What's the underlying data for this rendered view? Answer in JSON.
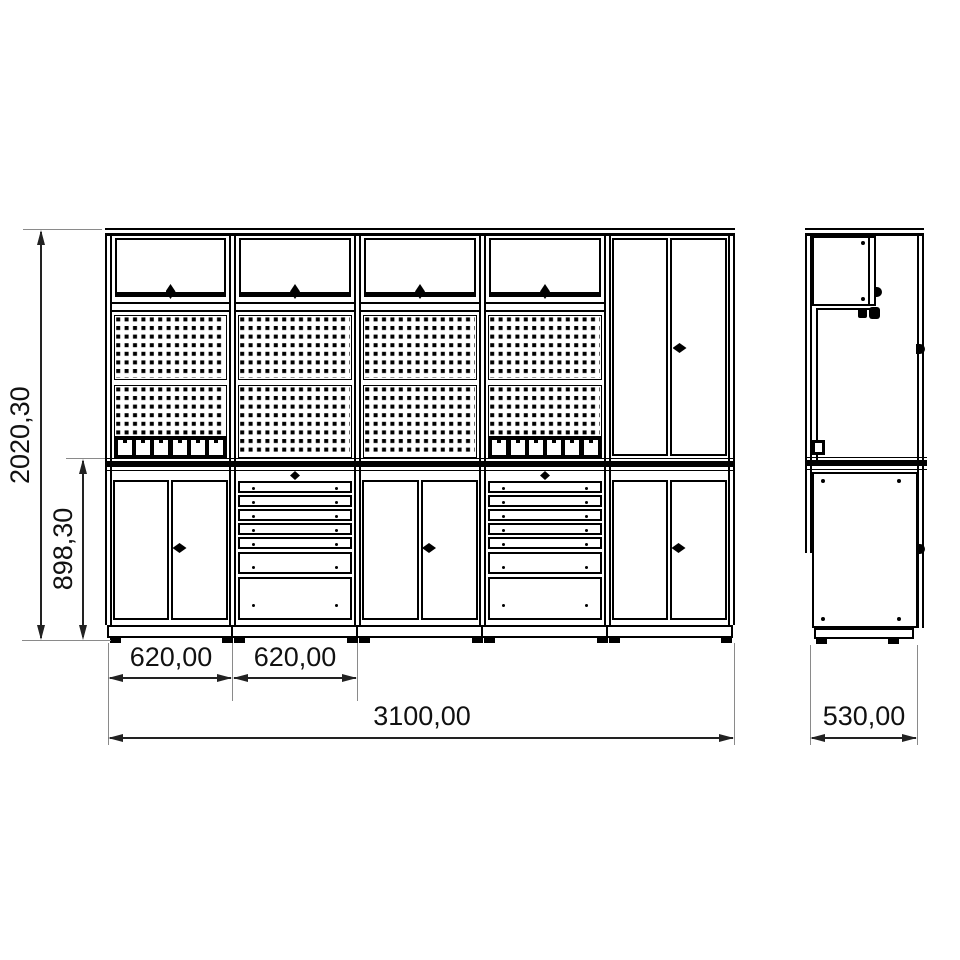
{
  "drawing_title": "modular-workbench-technical-drawing",
  "dimensions": {
    "total_height": "2020,30",
    "bench_height": "898,30",
    "module_width_1": "620,00",
    "module_width_2": "620,00",
    "total_width": "3100,00",
    "depth": "530,00"
  },
  "colors": {
    "line": "#000000",
    "dimension_line": "#222222",
    "extension_line": "#8a8a8a",
    "background": "#ffffff"
  },
  "front_view": {
    "upper_row": {
      "flip_door_cabinets": 4,
      "handle": "diamond"
    },
    "wall_panels": [
      {
        "bay": 1,
        "type": "pegboard",
        "tool_rail": true
      },
      {
        "bay": 2,
        "type": "pegboard",
        "tool_rail": false
      },
      {
        "bay": 3,
        "type": "pegboard",
        "tool_rail": false
      },
      {
        "bay": 4,
        "type": "pegboard",
        "tool_rail": true
      }
    ],
    "base_row": [
      {
        "bay": 1,
        "type": "double-door-cabinet"
      },
      {
        "bay": 2,
        "type": "drawer-unit",
        "drawers": {
          "thin": 5,
          "medium": 1,
          "large": 1
        }
      },
      {
        "bay": 3,
        "type": "double-door-cabinet"
      },
      {
        "bay": 4,
        "type": "drawer-unit",
        "drawers": {
          "thin": 5,
          "medium": 1,
          "large": 1
        }
      },
      {
        "bay": 5,
        "type": "tall-cabinet-double-doors"
      }
    ],
    "tool_rail_slots": 6,
    "worktop": true
  },
  "side_view": {
    "features": [
      "wall-cabinet",
      "back-frame",
      "worktop",
      "base-cabinet",
      "plinth-feet"
    ]
  }
}
